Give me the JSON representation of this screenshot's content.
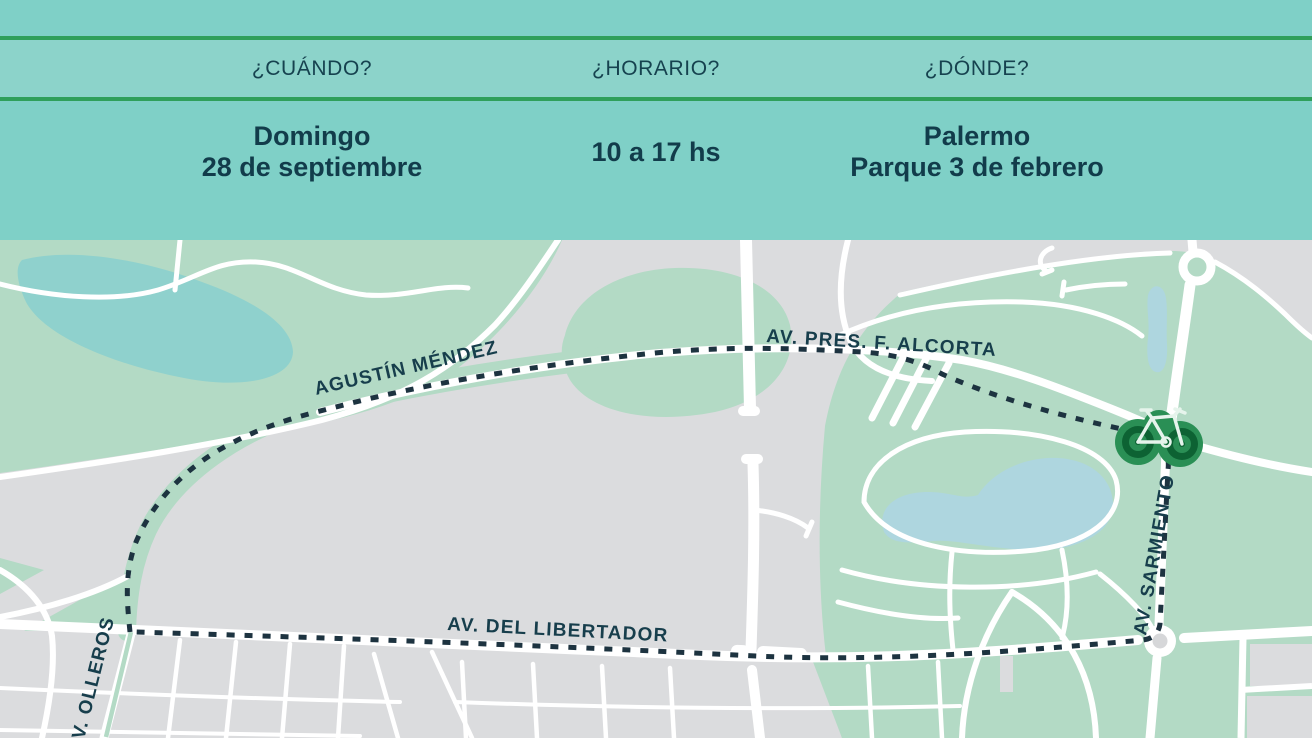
{
  "header": {
    "columns": [
      {
        "id": "cuando",
        "question": "¿CUÁNDO?",
        "answer_lines": [
          "Domingo",
          "28 de septiembre"
        ]
      },
      {
        "id": "horario",
        "question": "¿HORARIO?",
        "answer_lines": [
          "10 a 17 hs"
        ]
      },
      {
        "id": "donde",
        "question": "¿DÓNDE?",
        "answer_lines": [
          "Palermo",
          "Parque 3 de febrero"
        ]
      }
    ]
  },
  "map": {
    "street_labels": {
      "agustin_mendez": "AGUSTÍN MÉNDEZ",
      "alcorta": "AV. PRES. F. ALCORTA",
      "libertador": "AV. DEL LIBERTADOR",
      "sarmiento": "AV. SARMIENTO",
      "olleros": "V. OLLEROS"
    },
    "route": {
      "style": "dotted-loop"
    },
    "marker": {
      "icon": "bicycle-icon"
    }
  },
  "colors": {
    "band_teal": "#7fd0c7",
    "band_teal_light": "#8cd3ca",
    "divider_green": "#2f9f5b",
    "text_dark": "#14404e",
    "map_gray": "#dbdcde",
    "park_green": "#b3dac5",
    "lake_teal": "#8fd1cd",
    "lake_blue": "#aed6df",
    "route_navy": "#1d3340",
    "bike_green_dark": "#0d6233",
    "bike_green_mid": "#2a8f55"
  }
}
